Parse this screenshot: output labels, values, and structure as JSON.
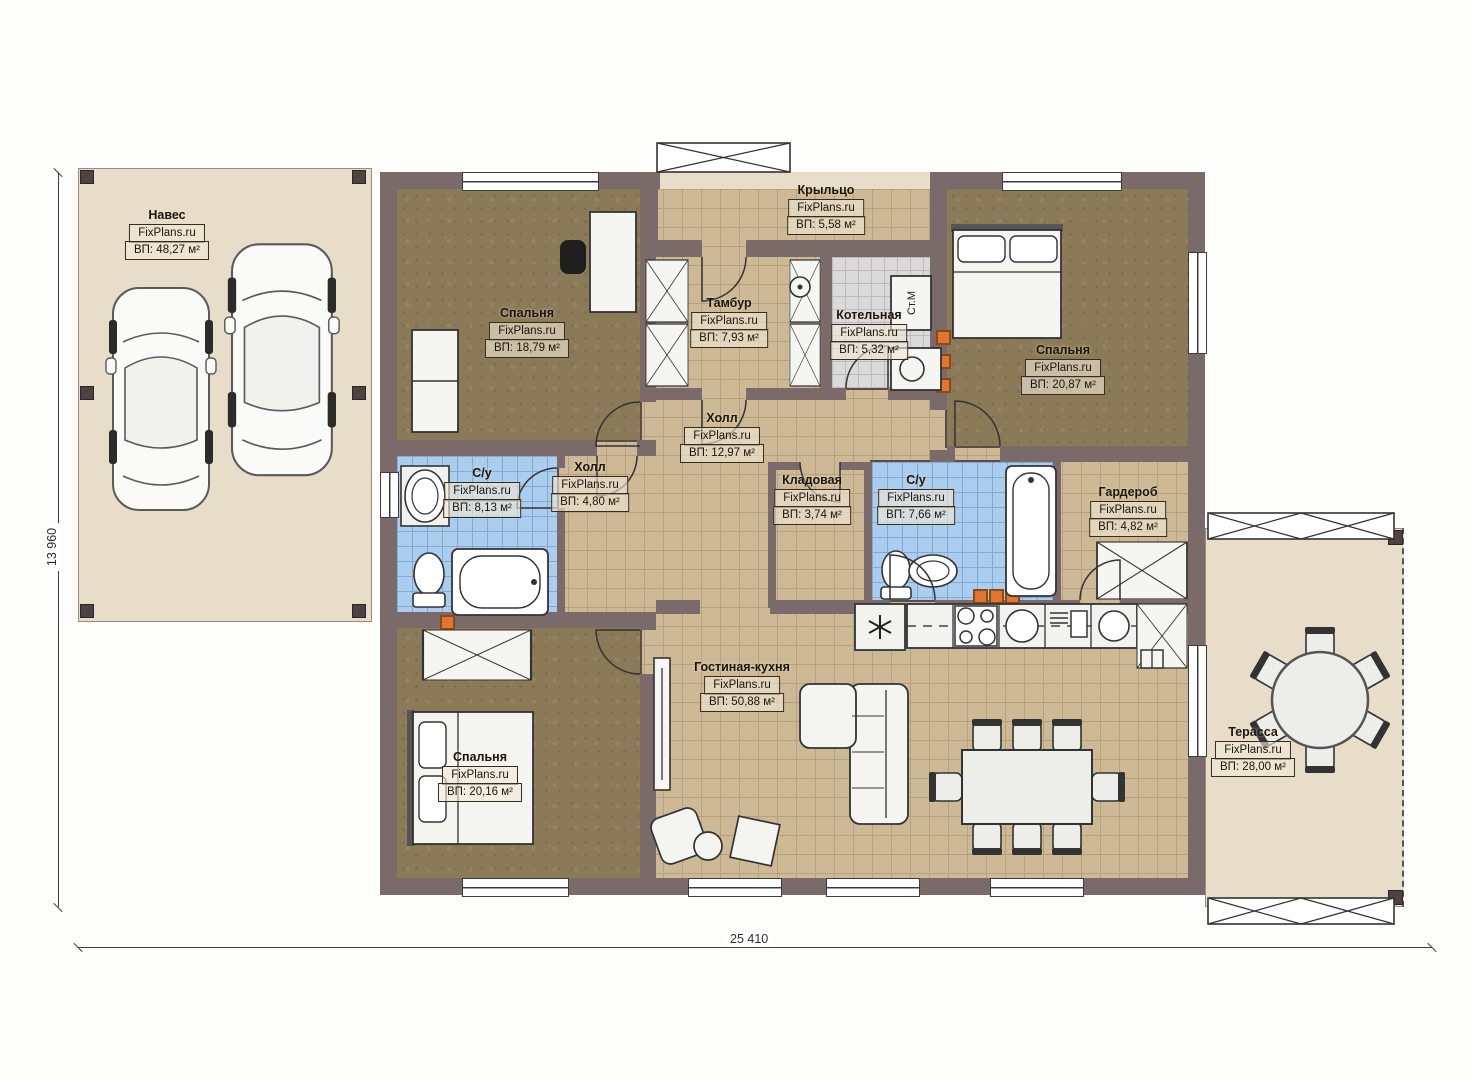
{
  "watermark": "FixPlans.ru",
  "dimensions": {
    "width_label": "25 410",
    "height_label": "13 960"
  },
  "labels": {
    "washing_machine": "Ст.М"
  },
  "rooms": [
    {
      "name": "Навес",
      "area": "ВП: 48,27 м²"
    },
    {
      "name": "Крыльцо",
      "area": "ВП: 5,58 м²"
    },
    {
      "name": "Спальня",
      "area": "ВП: 18,79 м²"
    },
    {
      "name": "Тамбур",
      "area": "ВП: 7,93 м²"
    },
    {
      "name": "Котельная",
      "area": "ВП: 5,32 м²"
    },
    {
      "name": "Спальня",
      "area": "ВП: 20,87 м²"
    },
    {
      "name": "Холл",
      "area": "ВП: 12,97 м²"
    },
    {
      "name": "Холл",
      "area": "ВП: 4,80 м²"
    },
    {
      "name": "С/у",
      "area": "ВП: 8,13 м²"
    },
    {
      "name": "Кладовая",
      "area": "ВП: 3,74 м²"
    },
    {
      "name": "С/у",
      "area": "ВП: 7,66 м²"
    },
    {
      "name": "Гардероб",
      "area": "ВП: 4,82 м²"
    },
    {
      "name": "Спальня",
      "area": "ВП: 20,16 м²"
    },
    {
      "name": "Гостиная-кухня",
      "area": "ВП: 50,88 м²"
    },
    {
      "name": "Терасса",
      "area": "ВП: 28,00 м²"
    }
  ]
}
